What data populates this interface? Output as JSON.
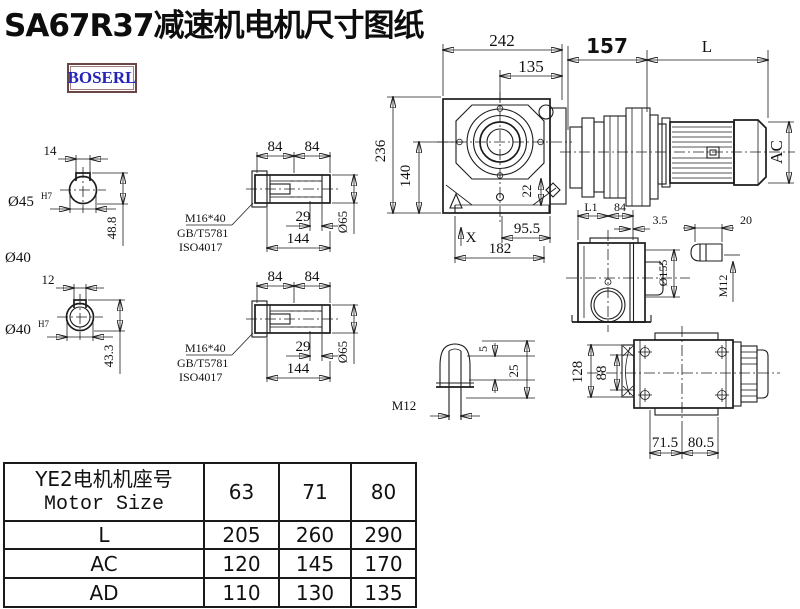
{
  "title": "SA67R37减速机电机尺寸图纸",
  "logo": "BOSERL",
  "colors": {
    "ink": "#1c1c1c",
    "logo_text": "#2323b8",
    "logo_border": "#6b4545"
  },
  "shaft_a": {
    "key_width": "14",
    "bore_dia": "Ø45",
    "bore_tol": "H7",
    "section_height": "48.8",
    "shaft_dia": "Ø40"
  },
  "shaft_b": {
    "key_width": "12",
    "bore_dia": "Ø40",
    "bore_tol": "H7",
    "section_height": "43.3"
  },
  "hub_top": {
    "half_len_1": "84",
    "half_len_2": "84",
    "bolt_spec": "M16*40",
    "bolt_std_1": "GB/T5781",
    "bolt_std_2": "ISO4017",
    "thread_depth": "29",
    "total_len": "144",
    "hub_dia": "Ø65"
  },
  "hub_bottom": {
    "half_len_1": "84",
    "half_len_2": "84",
    "bolt_spec": "M16*40",
    "bolt_std_1": "GB/T5781",
    "bolt_std_2": "ISO4017",
    "thread_depth": "29",
    "total_len": "144",
    "hub_dia": "Ø65"
  },
  "front_view": {
    "overall_width": "242",
    "center_to_face": "135",
    "adapter_length": "157",
    "motor_length": "L",
    "overall_height": "236",
    "axis_height": "140",
    "flange_offset": "22",
    "foot_to_axis": "95.5",
    "foot_length": "182",
    "x_mark": "X",
    "motor_dia": "AC"
  },
  "side_view": {
    "dim_l1": "L1",
    "dim_84": "84",
    "plate_thickness": "3.5",
    "plug_length": "20",
    "flange_dia": "Ø155",
    "plug_thread": "M12"
  },
  "plug_detail": {
    "tip_height": "5",
    "total_height": "25",
    "thread": "M12"
  },
  "bottom_view": {
    "flange_height": "128",
    "slot_width": "88",
    "foot_left": "71.5",
    "foot_right": "80.5"
  },
  "table": {
    "header_cn": "YE2电机机座号",
    "header_en": "Motor Size",
    "sizes": [
      "63",
      "71",
      "80"
    ],
    "rows": [
      {
        "label": "L",
        "values": [
          "205",
          "260",
          "290"
        ]
      },
      {
        "label": "AC",
        "values": [
          "120",
          "145",
          "170"
        ]
      },
      {
        "label": "AD",
        "values": [
          "110",
          "130",
          "135"
        ]
      }
    ]
  }
}
